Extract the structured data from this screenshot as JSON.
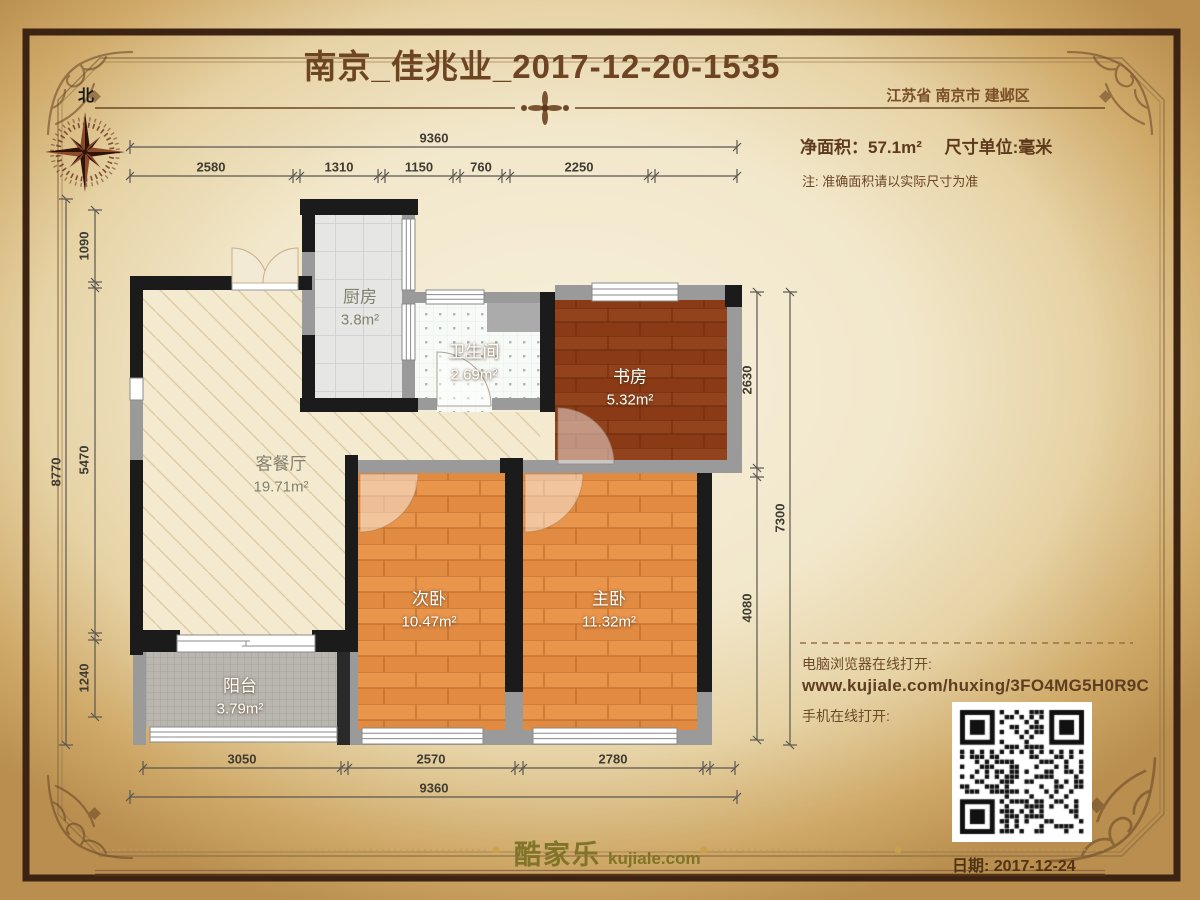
{
  "page": {
    "title": "南京_佳兆业_2017-12-20-1535",
    "region": "江苏省 南京市 建邺区"
  },
  "compass": {
    "north": "北"
  },
  "info": {
    "net_area": "净面积：57.1m²",
    "unit": "尺寸单位:毫米",
    "note": "注: 准确面积请以实际尺寸为准"
  },
  "links": {
    "pc": "电脑浏览器在线打开:",
    "url": "www.kujiale.com/huxing/3FO4MG5H0R9C",
    "mobile": "手机在线打开:",
    "qr_icon": "qr-code"
  },
  "footer": {
    "logo_cn": "酷家乐",
    "logo_en": "kujiale.com",
    "date": "日期: 2017-12-24"
  },
  "rooms": {
    "kitchen": {
      "name": "厨房",
      "area": "3.8m²"
    },
    "bath": {
      "name": "卫生间",
      "area": "2.69m²"
    },
    "study": {
      "name": "书房",
      "area": "5.32m²"
    },
    "living": {
      "name": "客餐厅",
      "area": "19.71m²"
    },
    "bed2": {
      "name": "次卧",
      "area": "10.47m²"
    },
    "bed1": {
      "name": "主卧",
      "area": "11.32m²"
    },
    "balcony": {
      "name": "阳台",
      "area": "3.79m²"
    }
  },
  "dims": {
    "top": {
      "outer": "9360",
      "segments": [
        "2580",
        "1310",
        "1150",
        "760",
        "2250"
      ]
    },
    "bottom": {
      "outer": "9360",
      "segments": [
        "3050",
        "2570",
        "2780"
      ]
    },
    "left": {
      "outer": "8770",
      "segments": [
        "1090",
        "5470",
        "1240"
      ]
    },
    "right": {
      "outer": "7300",
      "segments": [
        "2630",
        "4080"
      ]
    }
  },
  "colors": {
    "accent_brown": "#6d4522",
    "wall_black": "#1b1b1b",
    "wall_gray": "#9a9a9a",
    "floor_wood_orange": "#e08a42",
    "floor_wood_dark": "#8a3b16",
    "floor_living": "#f4ead0",
    "logo_olive": "#7f7428"
  }
}
